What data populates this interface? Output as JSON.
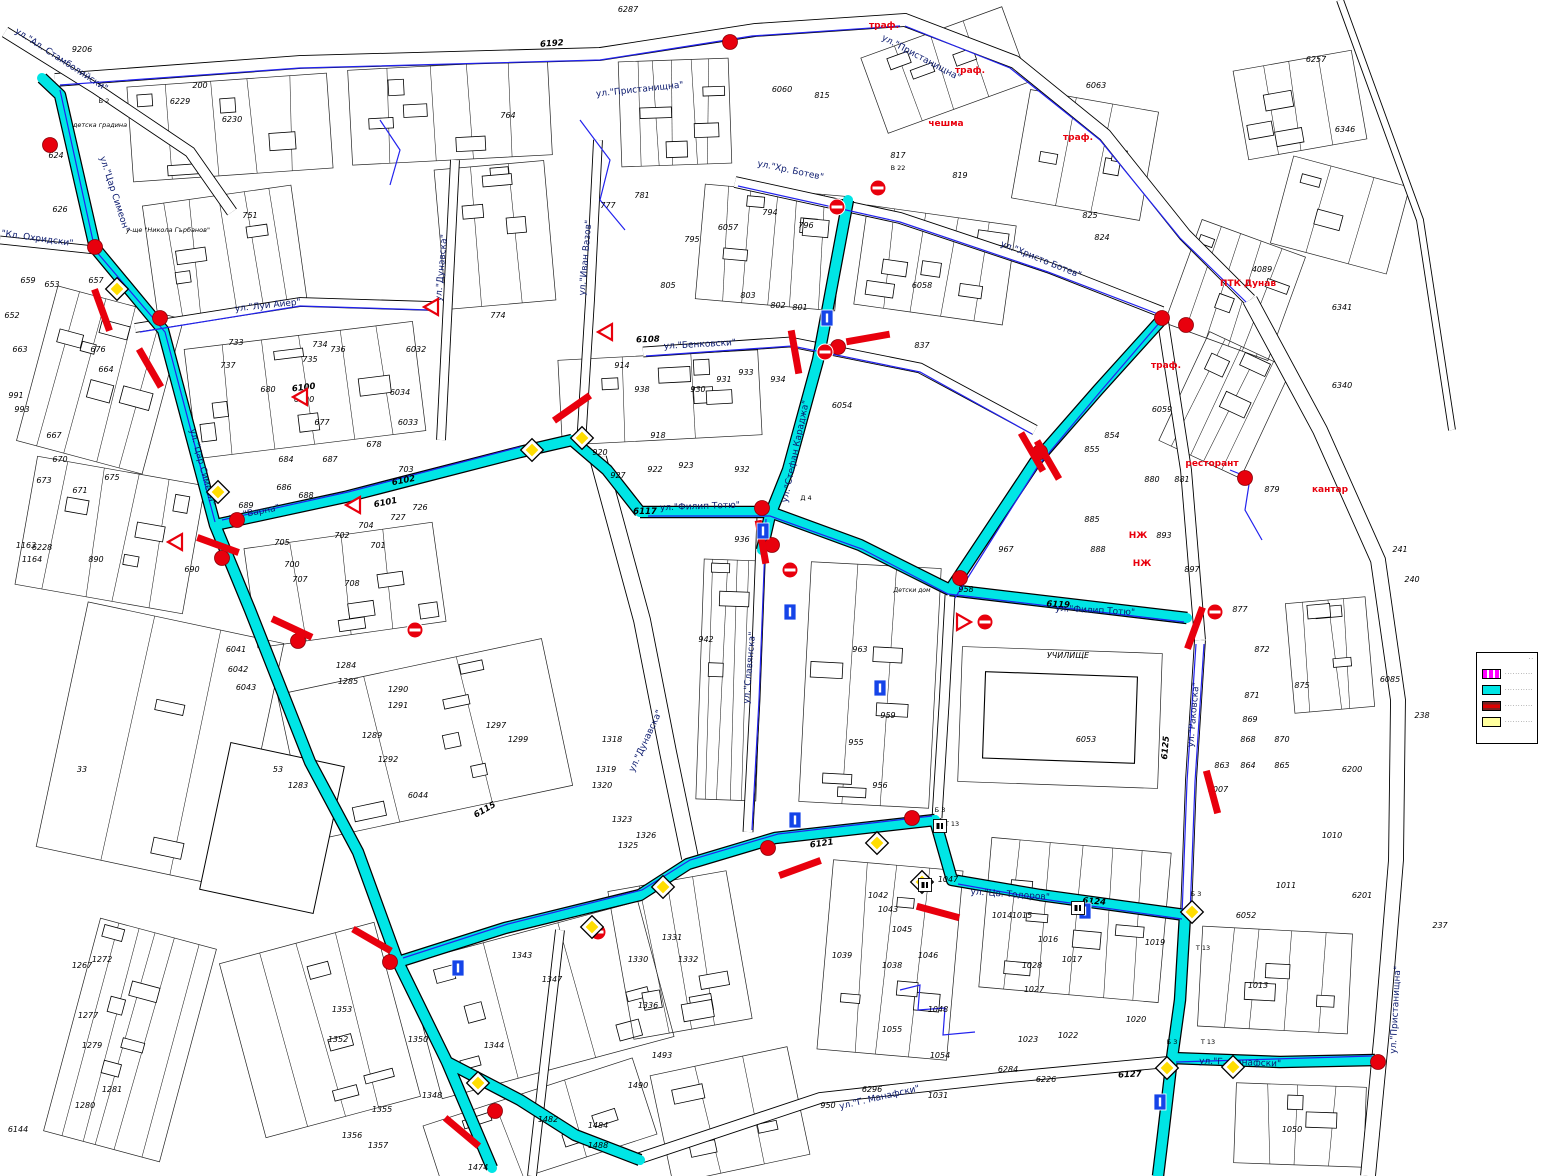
{
  "map": {
    "colors": {
      "route_cyan": "#00e5e5",
      "secondary_blue": "#2222ee",
      "sign_red": "#e8000d",
      "diamond_yellow": "#ffdd00",
      "legend_magenta": "#ff00ff",
      "legend_yellow": "#ffff9e"
    },
    "street_labels": [
      "ул.\"Ал. Стамболийски\"",
      "ул.\"Пристанищна\"",
      "ул.\"Пристанищна\"",
      "ул.\"Пристанищна\"",
      "ул.\"Цар Симеон\"",
      "ул.\"Цар Симеон\"",
      "ул.\"Кл. Охридски\"",
      "ул.\"Луи Айер\"",
      "ул.\"Варна\"",
      "ул.\"Филип Тотю\"",
      "ул.\"Филип Тотю\"",
      "ул.\"Хр. Ботев\"",
      "ул.\"Христо Ботев\"",
      "ул.\"Бенковски\"",
      "ул.\"Стефан Караджа\"",
      "ул.\"Иван Вазов\"",
      "ул.\"Дунавска\"",
      "ул.\"Дунавска\"",
      "ул.\"Славянска\"",
      "ул.\"Раковска\"",
      "ул.\"Цв. Тодоров\"",
      "ул.\"Г. Манафски\"",
      "ул.\"Г. Манафски\""
    ],
    "axis_numbers": [
      "6192",
      "6108",
      "6101",
      "6102",
      "6117",
      "6119",
      "6121",
      "6124",
      "6125",
      "6127",
      "6100",
      "6115"
    ],
    "red_labels": [
      "траф.",
      "траф.",
      "траф.",
      "чешма",
      "ПТК Дунав",
      "ресторант",
      "кантар",
      "НЖ",
      "НЖ",
      "траф."
    ],
    "area_labels": [
      "детска градина",
      "у-ще \"Никола Гърбанов\"",
      "УЧИЛИЩЕ",
      "Детски дом"
    ],
    "sign_codes": [
      "Б 2",
      "Д 4",
      "Б 3",
      "Т 13",
      "Б 3",
      "Т 13",
      "Б 3",
      "Т 13",
      "В 22"
    ],
    "parcel_numbers": [
      "9206",
      "200",
      "6230",
      "6229",
      "751",
      "624",
      "626",
      "653",
      "657",
      "659",
      "652",
      "663",
      "676",
      "664",
      "991",
      "993",
      "667",
      "670",
      "673",
      "671",
      "675",
      "6228",
      "1163",
      "1164",
      "890",
      "684",
      "687",
      "686",
      "688",
      "689",
      "690",
      "700",
      "704",
      "702",
      "701",
      "703",
      "705",
      "707",
      "708",
      "726",
      "727",
      "733",
      "734",
      "735",
      "736",
      "737",
      "680",
      "677",
      "678",
      "6032",
      "6033",
      "6034",
      "6100",
      "774",
      "764",
      "777",
      "781",
      "794",
      "795",
      "796",
      "805",
      "802",
      "801",
      "803",
      "817",
      "819",
      "824",
      "825",
      "837",
      "914",
      "918",
      "938",
      "930",
      "933",
      "931",
      "934",
      "920",
      "922",
      "923",
      "927",
      "932",
      "936",
      "942",
      "955",
      "959",
      "963",
      "956",
      "967",
      "958",
      "6053",
      "6054",
      "6057",
      "6058",
      "6059",
      "6060",
      "815",
      "6063",
      "4089",
      "6341",
      "6340",
      "6346",
      "6257",
      "6287",
      "854",
      "855",
      "881",
      "880",
      "893",
      "897",
      "885",
      "888",
      "879",
      "871",
      "869",
      "868",
      "870",
      "863",
      "864",
      "865",
      "872",
      "875",
      "877",
      "6085",
      "241",
      "240",
      "238",
      "237",
      "6200",
      "6201",
      "6052",
      "1007",
      "1010",
      "1011",
      "1013",
      "1014",
      "1015",
      "1016",
      "1017",
      "1019",
      "1020",
      "1023",
      "1022",
      "1028",
      "1027",
      "1031",
      "1038",
      "1039",
      "1042",
      "1043",
      "1045",
      "1046",
      "1047",
      "1048",
      "1050",
      "1054",
      "1055",
      "6284",
      "6226",
      "6296",
      "950",
      "1283",
      "1284",
      "1285",
      "1289",
      "1290",
      "1291",
      "1292",
      "1297",
      "1299",
      "1318",
      "1319",
      "1320",
      "1323",
      "1325",
      "1326",
      "1331",
      "1332",
      "1330",
      "1336",
      "1344",
      "1343",
      "1347",
      "1348",
      "1350",
      "1353",
      "1352",
      "1355",
      "1356",
      "1357",
      "1474",
      "1484",
      "1482",
      "1488",
      "1490",
      "1493",
      "53",
      "33",
      "6144",
      "6044",
      "6042",
      "6041",
      "6043",
      "1267",
      "1272",
      "1277",
      "1279",
      "1280",
      "1281"
    ],
    "legend": {
      "items": [
        {
          "label": "············"
        },
        {
          "label": "············"
        },
        {
          "label": "············"
        },
        {
          "label": "············"
        }
      ],
      "top_note": "··"
    }
  }
}
